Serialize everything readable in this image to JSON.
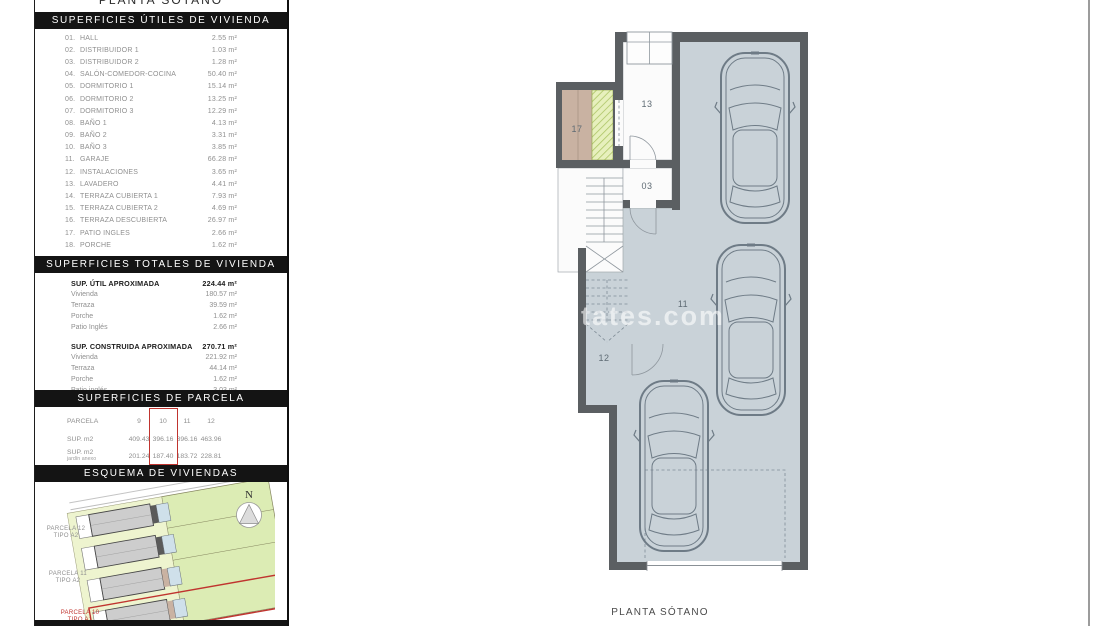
{
  "page": {
    "top_title": "PLANTA SÓTANO",
    "plan_caption": "PLANTA SÓTANO",
    "watermark": "states.com"
  },
  "colors": {
    "header_bar": "#141414",
    "accent_red": "#c0342f",
    "wall_gray": "#5b5f62",
    "garage_floor": "#c9d2d8",
    "patio_tan": "#c9b2a2",
    "hatch_green": "#e7f0bd",
    "text_gray": "#8f8f8f"
  },
  "sections": {
    "utiles": {
      "header": "SUPERFICIES ÚTILES DE VIVIENDA",
      "items": [
        {
          "n": "01.",
          "label": "HALL",
          "value": "2.55 m²"
        },
        {
          "n": "02.",
          "label": "DISTRIBUIDOR 1",
          "value": "1.03 m²"
        },
        {
          "n": "03.",
          "label": "DISTRIBUIDOR 2",
          "value": "1.28 m²"
        },
        {
          "n": "04.",
          "label": "SALÓN-COMEDOR-COCINA",
          "value": "50.40 m²"
        },
        {
          "n": "05.",
          "label": "DORMITORIO 1",
          "value": "15.14 m²"
        },
        {
          "n": "06.",
          "label": "DORMITORIO 2",
          "value": "13.25 m²"
        },
        {
          "n": "07.",
          "label": "DORMITORIO 3",
          "value": "12.29 m²"
        },
        {
          "n": "08.",
          "label": "BAÑO 1",
          "value": "4.13 m²"
        },
        {
          "n": "09.",
          "label": "BAÑO 2",
          "value": "3.31 m²"
        },
        {
          "n": "10.",
          "label": "BAÑO 3",
          "value": "3.85 m²"
        },
        {
          "n": "11.",
          "label": "GARAJE",
          "value": "66.28 m²"
        },
        {
          "n": "12.",
          "label": "INSTALACIONES",
          "value": "3.65 m²"
        },
        {
          "n": "13.",
          "label": "LAVADERO",
          "value": "4.41 m²"
        },
        {
          "n": "14.",
          "label": "TERRAZA CUBIERTA 1",
          "value": "7.93 m²"
        },
        {
          "n": "15.",
          "label": "TERRAZA CUBIERTA 2",
          "value": "4.69 m²"
        },
        {
          "n": "16.",
          "label": "TERRAZA DESCUBIERTA",
          "value": "26.97 m²"
        },
        {
          "n": "17.",
          "label": "PATIO INGLES",
          "value": "2.66 m²"
        },
        {
          "n": "18.",
          "label": "PORCHE",
          "value": "1.62 m²"
        }
      ]
    },
    "totales": {
      "header": "SUPERFICIES TOTALES DE VIVIENDA",
      "util": {
        "title": "SUP. ÚTIL APROXIMADA",
        "value": "224.44 m²",
        "rows": [
          {
            "label": "Vivienda",
            "value": "180.57 m²"
          },
          {
            "label": "Terraza",
            "value": "39.59 m²"
          },
          {
            "label": "Porche",
            "value": "1.62 m²"
          },
          {
            "label": "Patio Inglés",
            "value": "2.66 m²"
          }
        ]
      },
      "construida": {
        "title": "SUP. CONSTRUIDA APROXIMADA",
        "value": "270.71 m²",
        "rows": [
          {
            "label": "Vivienda",
            "value": "221.92 m²"
          },
          {
            "label": "Terraza",
            "value": "44.14 m²"
          },
          {
            "label": "Porche",
            "value": "1.62 m²"
          },
          {
            "label": "Patio inglés",
            "value": "3.03 m²"
          }
        ]
      }
    },
    "parcela": {
      "header": "SUPERFICIES DE PARCELA",
      "header_label": "PARCELA",
      "columns": [
        "9",
        "10",
        "11",
        "12"
      ],
      "highlighted_column": "10",
      "row1": {
        "label": "SUP. m2",
        "values": [
          "409.43",
          "396.16",
          "396.16",
          "463.96"
        ]
      },
      "row2": {
        "label": "SUP. m2",
        "sub": "jardín anexo",
        "values": [
          "201.24",
          "187.40",
          "183.72",
          "228.81"
        ]
      }
    },
    "esquema": {
      "header": "ESQUEMA DE VIVIENDAS",
      "north": "N",
      "label12": {
        "line1": "PARCELA 12",
        "line2": "TIPO A2"
      },
      "label11": {
        "line1": "PARCELA 11",
        "line2": "TIPO A2"
      },
      "label10": {
        "line1": "PARCELA 10",
        "line2": "TIPO A1"
      }
    }
  },
  "plan": {
    "room17": "17",
    "room13": "13",
    "room03": "03",
    "room11": "11",
    "room12": "12"
  }
}
